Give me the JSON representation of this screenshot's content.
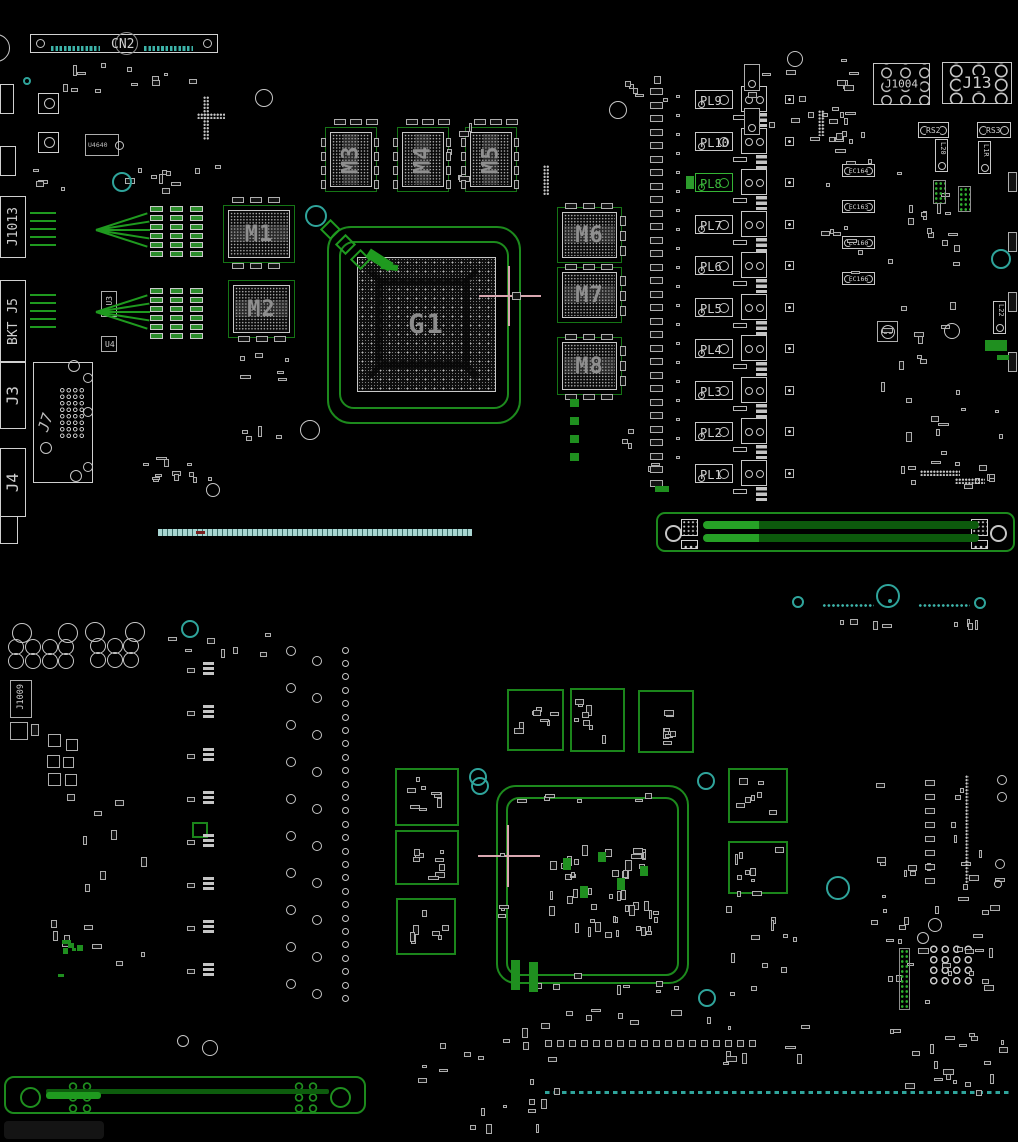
{
  "board": {
    "bg": "#000000",
    "accent_green": "#1d8a1d",
    "accent_teal": "#2fa49b",
    "selected_color": "#35b435"
  },
  "top_side": {
    "cn2_label": "CN2",
    "edge_labels": {
      "j1013": "J1013",
      "bkt": "BKT J5",
      "j3": "J3",
      "j7": "J7",
      "j4": "J4"
    },
    "ics": {
      "u4640": "U4640",
      "u3": "U3",
      "u4": "U4",
      "u6": "U6"
    },
    "gpu_label": "G1",
    "mem_labels": [
      "M1",
      "M2",
      "M3",
      "M4",
      "M5",
      "M6",
      "M7",
      "M8"
    ],
    "inductor_labels": [
      "PL9",
      "PL10",
      "PL8",
      "PL7",
      "PL6",
      "PL5",
      "PL4",
      "PL3",
      "PL2",
      "PL1"
    ],
    "selected_component": "PL8",
    "connector_labels": {
      "j1004": "J1004",
      "j13": "J13"
    },
    "shunt_labels": {
      "rs2": "RS2",
      "rs3": "RS3"
    },
    "coil_labels": {
      "l20": "L20",
      "l1r": "L1R",
      "l22": "L22"
    },
    "cap_labels": [
      "EC164",
      "EC163",
      "EC160",
      "EC166"
    ]
  },
  "bottom_side": {
    "j1009_label": "J1009"
  }
}
